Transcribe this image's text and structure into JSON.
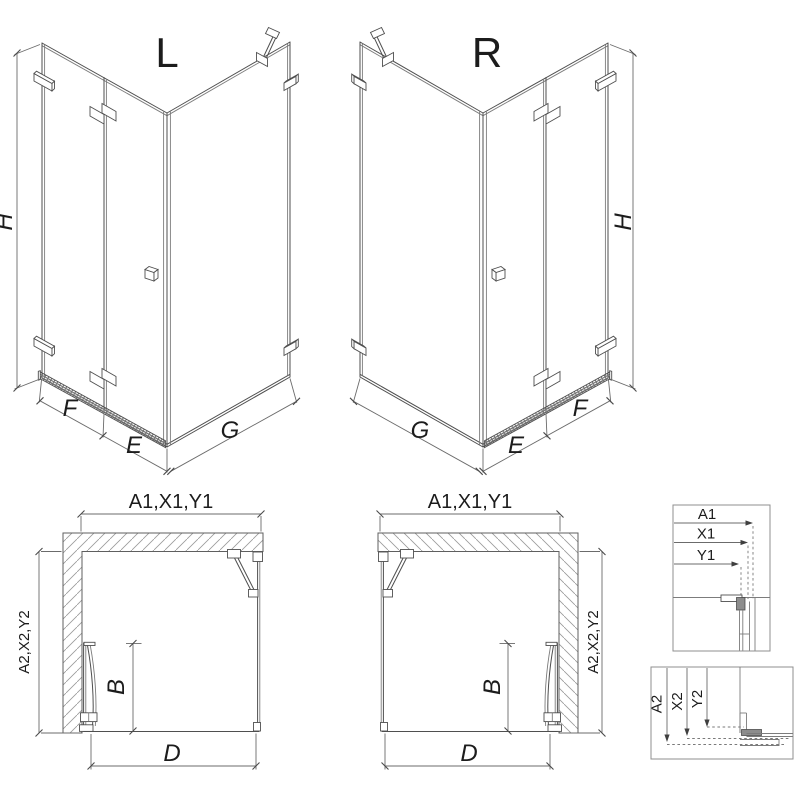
{
  "drawing": {
    "kind": "shower-enclosure-technical-drawing",
    "colors": {
      "line": "#4f4f4f",
      "dim_line": "#6b6b6b",
      "hatch": "#9a9a9a",
      "text": "#1c1c1c",
      "background": "#ffffff"
    },
    "iso_left": {
      "variant_label": "L",
      "dim_height": "H",
      "dim_fixed_panel": "F",
      "dim_door": "E",
      "dim_side_panel": "G"
    },
    "iso_right": {
      "variant_label": "R",
      "dim_height": "H",
      "dim_fixed_panel": "F",
      "dim_door": "E",
      "dim_side_panel": "G"
    },
    "plan_left": {
      "dim_width_top": "A1,X1,Y1",
      "dim_depth_side": "A2,X2,Y2",
      "dim_door_leaf": "B",
      "dim_entry": "D"
    },
    "plan_right": {
      "dim_width_top": "A1,X1,Y1",
      "dim_depth_side": "A2,X2,Y2",
      "dim_door_leaf": "B",
      "dim_entry": "D"
    },
    "detail_box_top": {
      "labels": [
        "A1",
        "X1",
        "Y1"
      ]
    },
    "detail_box_bottom": {
      "labels": [
        "A2",
        "X2",
        "Y2"
      ]
    }
  }
}
